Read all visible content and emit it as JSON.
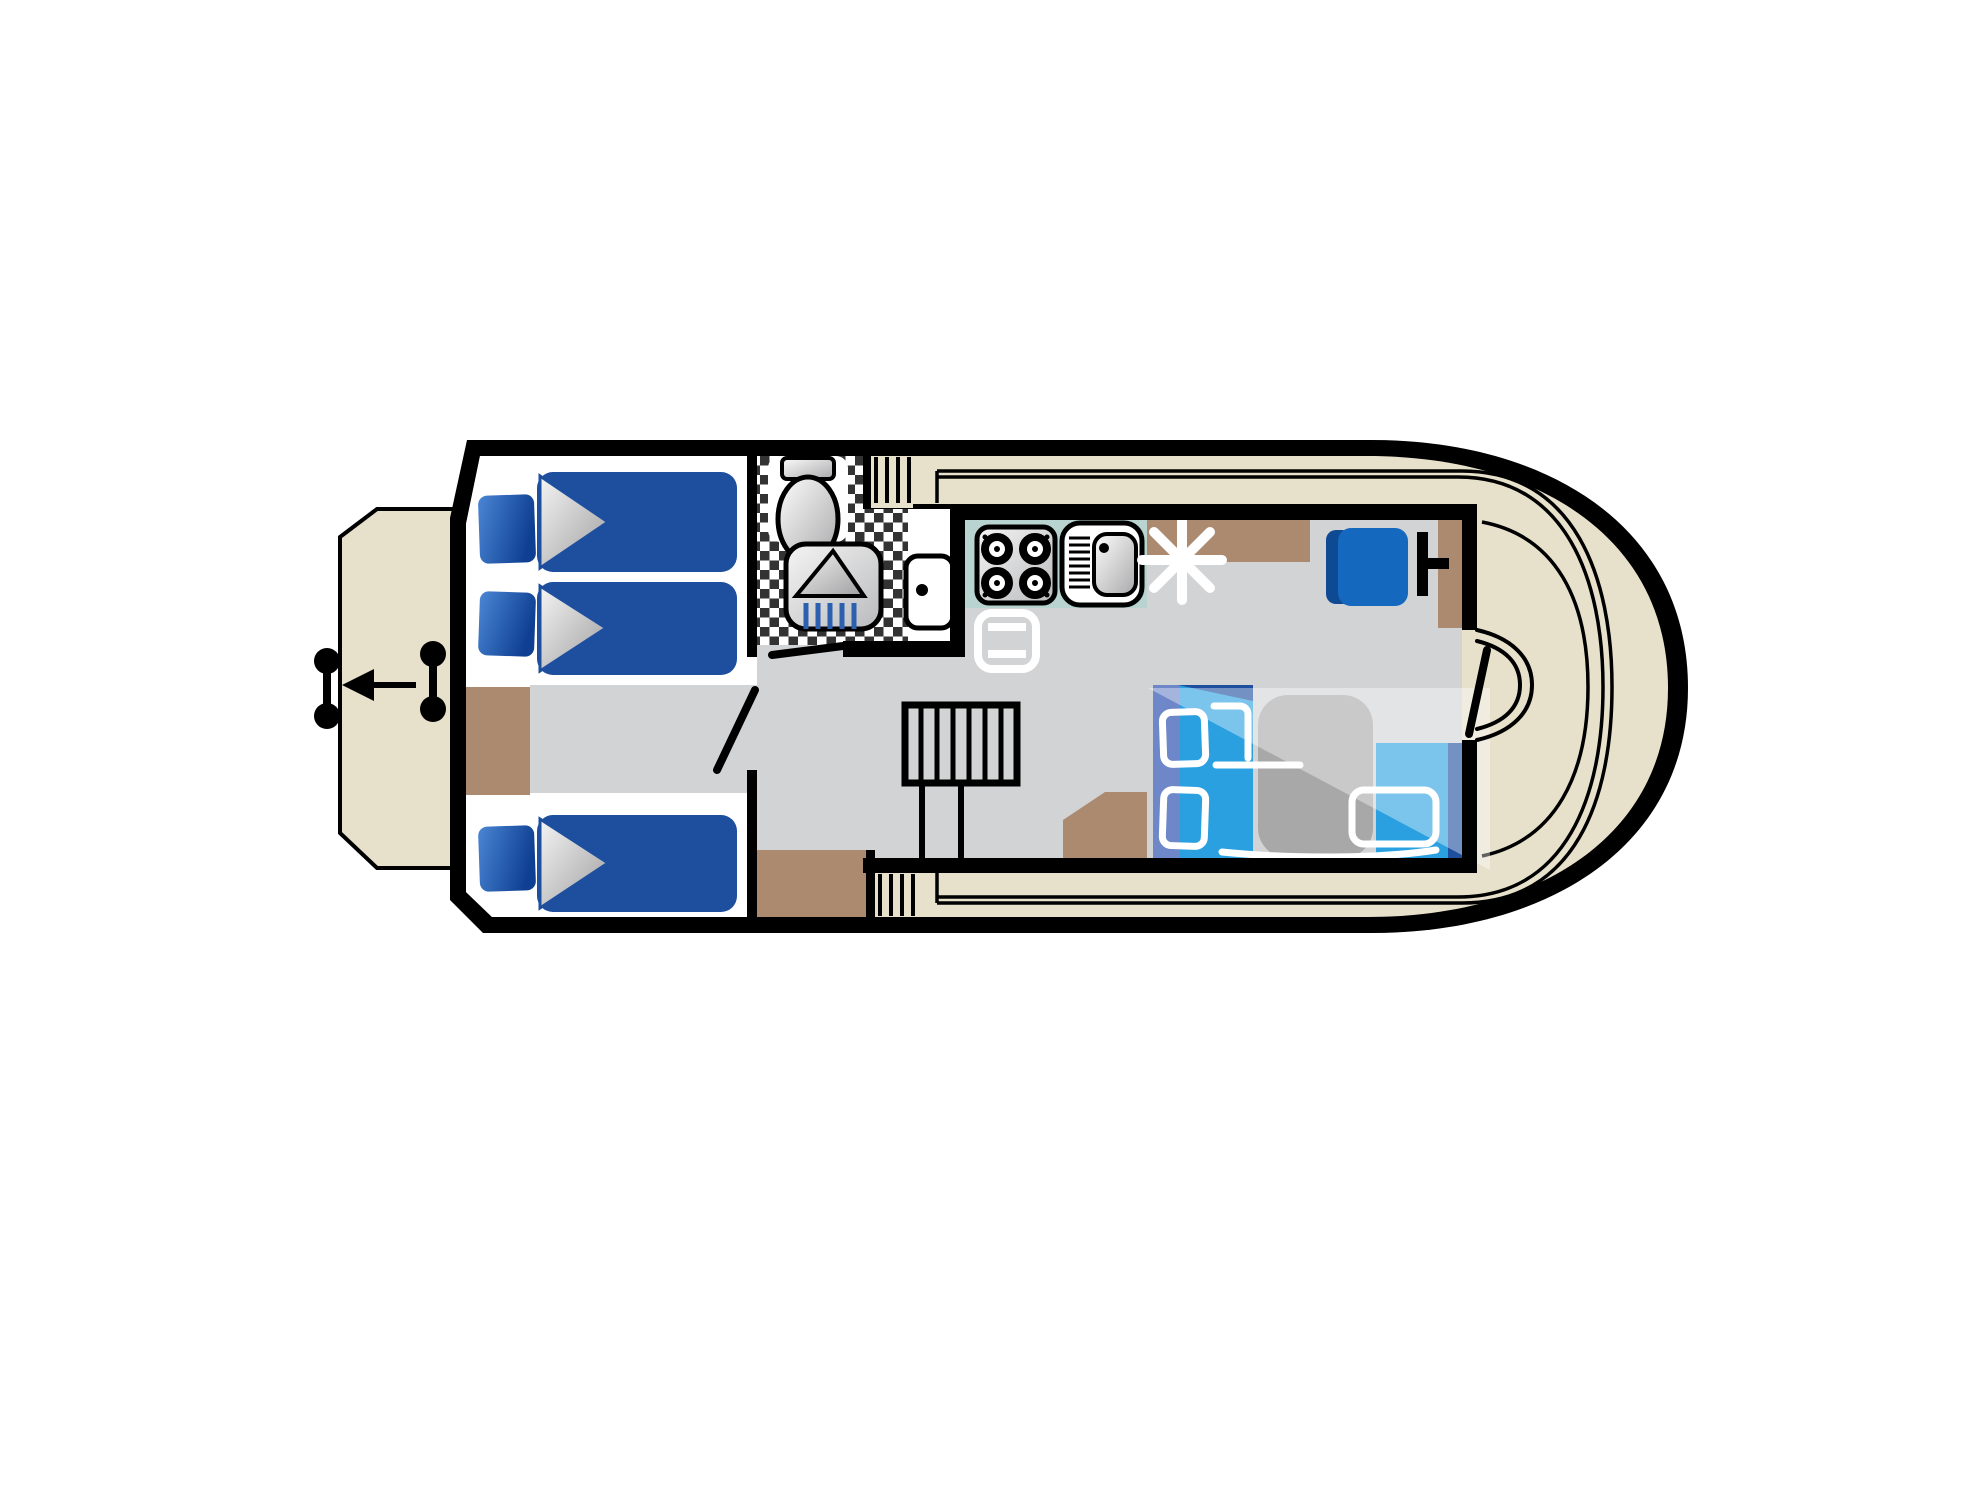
{
  "diagram": {
    "type": "houseboat-floorplan",
    "orientation": "bow-left",
    "title": "Boat deck plan (top view)"
  },
  "colors": {
    "ink": "#000000",
    "deckBeige": "#e7e1cb",
    "deckInner": "#ded5bb",
    "floorGray": "#d2d3d5",
    "cabinWhite": "#ffffff",
    "bedNavy": "#1d4f9e",
    "pillowLight": "#4a86d4",
    "pillowDark": "#0f3f92",
    "sheetLight": "#f4f4f4",
    "sheetDark": "#9f9fa1",
    "brown": "#ab8a70",
    "teal": "#b9d3d0",
    "checkerDark": "#333333",
    "dinetteBlue": "#2aa0e0",
    "dinettePeriwinkle": "#6e87c9",
    "dinetteNavy": "#1d4f9e",
    "tableGray": "#a8a8a8",
    "helmBlue": "#1468be",
    "helmDark": "#0e4a94",
    "dropBlue": "#2b5fb0",
    "steelLight": "#f5f5f5",
    "steelDark": "#b9babc",
    "highlight": "rgba(255,255,255,0.38)"
  },
  "rooms": [
    {
      "id": "bow-platform",
      "name": "Bow boarding platform",
      "items": [
        "grab handle",
        "grab handle",
        "boarding direction arrow"
      ]
    },
    {
      "id": "forward-cabin",
      "name": "Forward sleeping cabin",
      "items": [
        "single bed",
        "single bed",
        "single bed",
        "cabinet",
        "cabinet",
        "cabin door"
      ]
    },
    {
      "id": "shower-room",
      "name": "Shower room",
      "items": [
        "toilet",
        "shower",
        "washbasin",
        "tiled floor",
        "door"
      ]
    },
    {
      "id": "galley",
      "name": "Galley",
      "items": [
        "four burner stove",
        "sink with drainer",
        "fridge",
        "worktop"
      ]
    },
    {
      "id": "saloon",
      "name": "Saloon / wheelhouse",
      "items": [
        "companionway stairs",
        "L-shaped dinette bench",
        "cushions",
        "table",
        "helm seat",
        "steering wheel",
        "console",
        "lamp symbol",
        "side-deck steps"
      ]
    },
    {
      "id": "aft-deck",
      "name": "Aft deck",
      "items": [
        "entry door with swing",
        "moulded deck lines"
      ]
    }
  ],
  "icons": [
    "toilet-icon",
    "shower-icon",
    "washbasin-icon",
    "stove-icon",
    "sink-icon",
    "fridge-icon",
    "lamp-star-icon",
    "steering-wheel-icon",
    "arrow-left-icon",
    "grab-handle-icon",
    "stairs-icon",
    "bed-icon",
    "pillow-icon"
  ]
}
